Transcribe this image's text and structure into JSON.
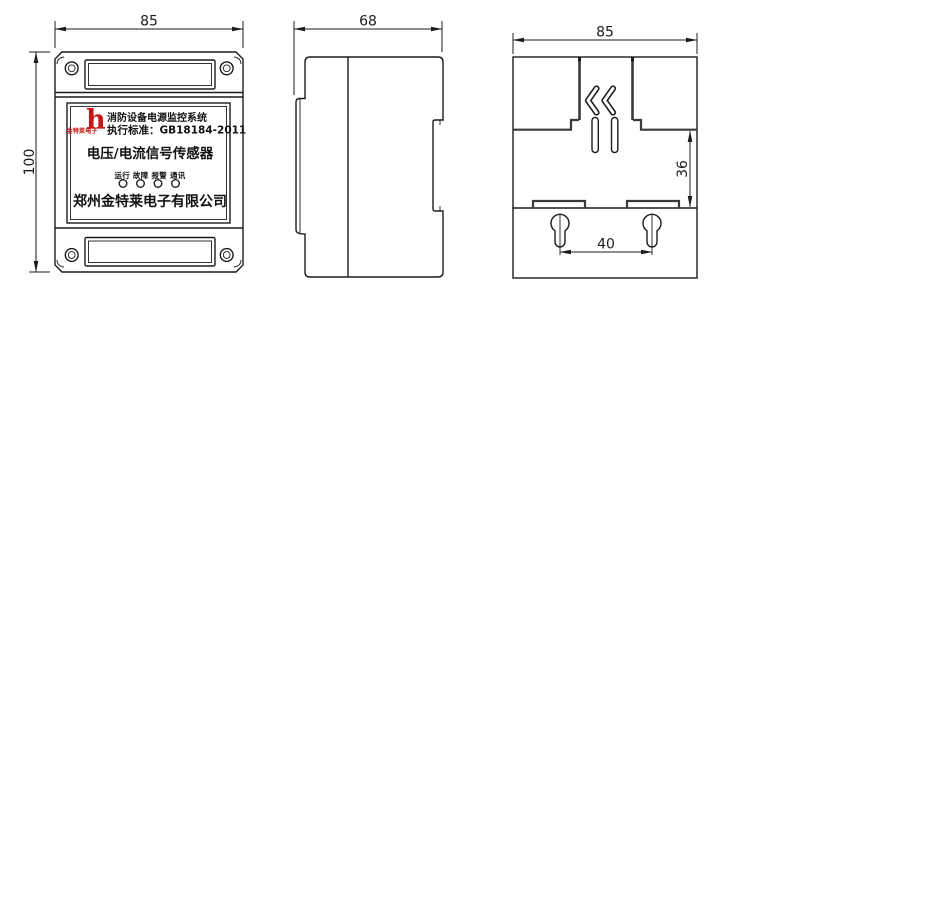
{
  "views": {
    "front": {
      "dim_width": "85",
      "dim_height": "100",
      "label": {
        "logo_letter": "h",
        "logo_brand": "金特莱电子",
        "line_system": "消防设备电源监控系统",
        "line_standard": "执行标准：GB18184-2011",
        "line_product": "电压/电流信号传感器",
        "line_indicators": "运行 故障 报警 通讯",
        "line_company": "郑州金特莱电子有限公司"
      }
    },
    "side": {
      "dim_width": "68"
    },
    "rear": {
      "dim_width": "85",
      "dim_clip_height": "36",
      "dim_hole_spacing": "40"
    }
  },
  "colors": {
    "line": "#1c1c1c",
    "logo_red": "#c41818"
  }
}
